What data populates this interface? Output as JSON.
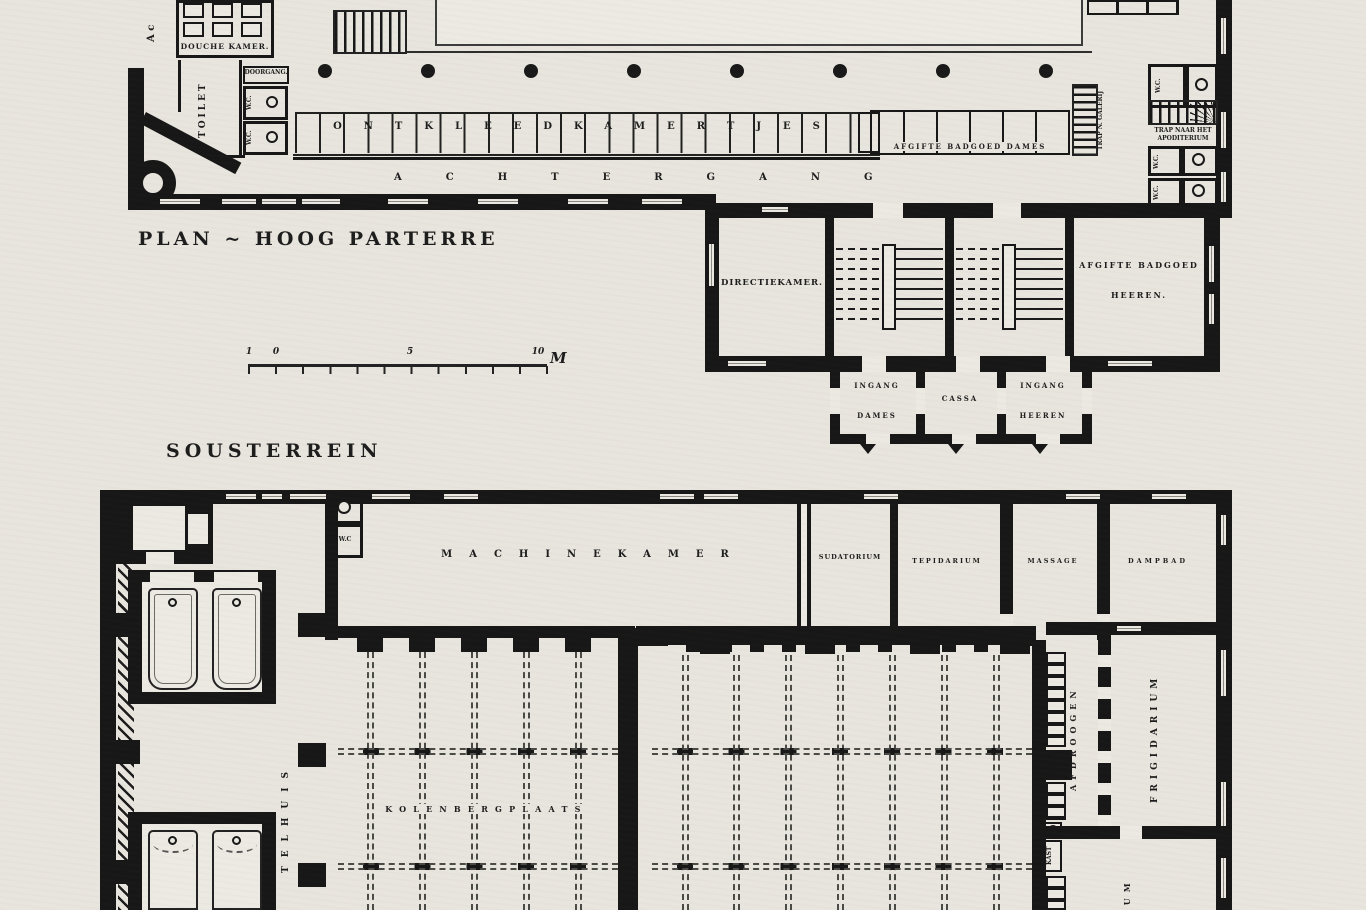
{
  "upper": {
    "title": "PLAN ~ HOOG PARTERRE",
    "axis": "A c",
    "rooms": {
      "douche_kamer": "DOUCHE KAMER.",
      "toilet": "TOILET",
      "doorgang": "DOORGANG.",
      "wc": "W.C.",
      "ontkleedkamertjes": "ONTKLEEDKAMERTJES",
      "achtergang": "ACHTERGANG",
      "afgifte_badgoed_dames": "AFGIFTE BADGOED DAMES",
      "trap_galerij": "TRAP N. GALERIJ",
      "trap_apoditerium_line1": "TRAP NAAR HET",
      "trap_apoditerium_line2": "APODITERIUM",
      "directiekamer": "DIRECTIEKAMER.",
      "afgifte_badgoed_heeren_line1": "AFGIFTE BADGOED",
      "afgifte_badgoed_heeren_line2": "HEEREN.",
      "ingang": "INGANG",
      "dames": "DAMES",
      "cassa": "CASSA",
      "heeren": "HEEREN"
    },
    "scale": {
      "ticks": [
        "1",
        "0",
        "5",
        "10"
      ],
      "unit": "M"
    }
  },
  "lower": {
    "title": "SOUSTERREIN",
    "rooms": {
      "machinekamer": "MACHINEKAMER",
      "wc": "W.C",
      "sudatorium": "SUDATORIUM",
      "tepidarium": "TEPIDARIUM",
      "massage": "MASSAGE",
      "dampbad": "DAMPBAD",
      "kolenbergplaats": "KOLENBERGPLAATS",
      "ketelhuis_partial": "TELHUIS",
      "afdroogen": "AFDROOGEN",
      "frigidarium": "FRIGIDARIUM",
      "kast": "KAST",
      "apoditerium_partial": "IUM"
    }
  }
}
